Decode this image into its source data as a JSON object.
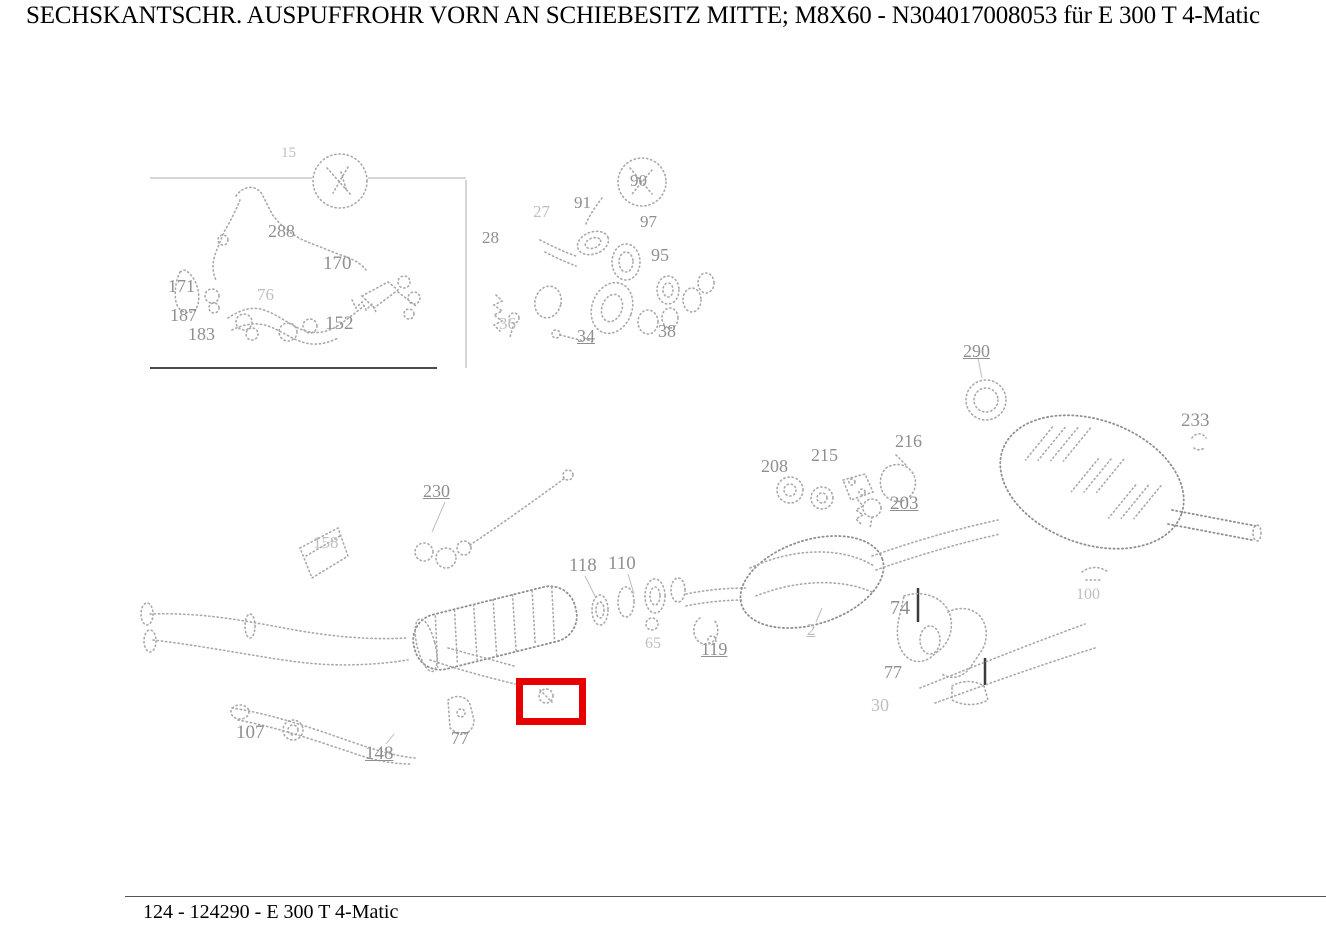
{
  "title": "SECHSKANTSCHR. AUSPUFFROHR VORN AN SCHIEBESITZ MITTE; M8X60 - N304017008053 für E 300 T 4-Matic",
  "footer": {
    "text": "124 - 124290 - E 300 T 4-Matic"
  },
  "highlight": {
    "x": 516,
    "y": 678,
    "width": 56,
    "height": 33,
    "color": "#e60000"
  },
  "colors": {
    "highlight_red": "#e60000",
    "label_gray": "#8f8f8f",
    "drawing_gray": "#a8a8a8",
    "text_black": "#000000"
  },
  "part_labels": [
    {
      "text": "15",
      "x": 281,
      "y": 146,
      "size": 15,
      "faint": true
    },
    {
      "text": "288",
      "x": 268,
      "y": 222,
      "size": 18
    },
    {
      "text": "170",
      "x": 323,
      "y": 254,
      "size": 19
    },
    {
      "text": "171",
      "x": 168,
      "y": 277,
      "size": 18
    },
    {
      "text": "76",
      "x": 257,
      "y": 286,
      "size": 17,
      "faint": true
    },
    {
      "text": "187",
      "x": 170,
      "y": 306,
      "size": 18
    },
    {
      "text": "152",
      "x": 325,
      "y": 314,
      "size": 19
    },
    {
      "text": "183",
      "x": 188,
      "y": 325,
      "size": 18
    },
    {
      "text": "90",
      "x": 630,
      "y": 172,
      "size": 17
    },
    {
      "text": "91",
      "x": 574,
      "y": 194,
      "size": 17
    },
    {
      "text": "97",
      "x": 640,
      "y": 213,
      "size": 17
    },
    {
      "text": "27",
      "x": 533,
      "y": 203,
      "size": 17,
      "faint": true
    },
    {
      "text": "28",
      "x": 482,
      "y": 229,
      "size": 17
    },
    {
      "text": "95",
      "x": 651,
      "y": 246,
      "size": 18
    },
    {
      "text": "36",
      "x": 499,
      "y": 315,
      "size": 17,
      "faint": true
    },
    {
      "text": "34",
      "x": 577,
      "y": 327,
      "size": 18,
      "underline": true
    },
    {
      "text": "38",
      "x": 658,
      "y": 322,
      "size": 18
    },
    {
      "text": "230",
      "x": 423,
      "y": 482,
      "size": 18,
      "underline": true
    },
    {
      "text": "158",
      "x": 313,
      "y": 534,
      "size": 17,
      "faint": true
    },
    {
      "text": "118",
      "x": 569,
      "y": 556,
      "size": 19
    },
    {
      "text": "110",
      "x": 608,
      "y": 554,
      "size": 19
    },
    {
      "text": "290",
      "x": 963,
      "y": 342,
      "size": 18,
      "underline": true
    },
    {
      "text": "233",
      "x": 1181,
      "y": 411,
      "size": 19
    },
    {
      "text": "208",
      "x": 761,
      "y": 457,
      "size": 18
    },
    {
      "text": "215",
      "x": 811,
      "y": 446,
      "size": 18
    },
    {
      "text": "216",
      "x": 895,
      "y": 432,
      "size": 18
    },
    {
      "text": "203",
      "x": 890,
      "y": 494,
      "size": 19,
      "underline": true
    },
    {
      "text": "74",
      "x": 890,
      "y": 598,
      "size": 20
    },
    {
      "text": "2",
      "x": 807,
      "y": 621,
      "size": 17,
      "underline": true,
      "faint": true
    },
    {
      "text": "65",
      "x": 645,
      "y": 636,
      "size": 16,
      "faint": true
    },
    {
      "text": "119",
      "x": 701,
      "y": 640,
      "size": 18,
      "underline": true
    },
    {
      "text": "77",
      "x": 884,
      "y": 663,
      "size": 18
    },
    {
      "text": "30",
      "x": 871,
      "y": 696,
      "size": 18,
      "faint": true
    },
    {
      "text": "100",
      "x": 1076,
      "y": 587,
      "size": 16,
      "faint": true
    },
    {
      "text": "107",
      "x": 236,
      "y": 723,
      "size": 19
    },
    {
      "text": "148",
      "x": 365,
      "y": 744,
      "size": 19,
      "underline": true
    },
    {
      "text": "77",
      "x": 451,
      "y": 729,
      "size": 18
    }
  ]
}
